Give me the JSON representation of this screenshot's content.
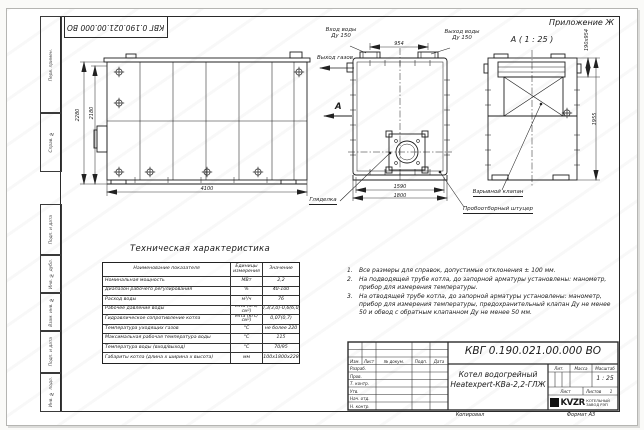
{
  "sheet": {
    "appendix_label": "Приложение Ж",
    "doc_number_flipped": "КВГ 0.190.021.00.000 ВО",
    "margin_stamps": [
      "Перв. примен.",
      "Справ. №",
      "Подп. и дата",
      "Инв. № дубл.",
      "Взам. инв. №",
      "Подп. и дата",
      "Инв. № подл."
    ],
    "copied_label": "Копировал",
    "format_label": "Формат А3"
  },
  "views": {
    "side": {
      "dim_height_total": "2280",
      "dim_height_body": "2180",
      "dim_length": "4100",
      "sight_glass_label": "Гляделка"
    },
    "plan": {
      "dim_flange_span": "954",
      "dim_inner_width": "1590",
      "dim_width": "1800",
      "inlet_line1": "Вход воды",
      "inlet_line2": "Ду 150",
      "outlet_line1": "Выход воды",
      "outlet_line2": "Ду 150",
      "gas_outlet_label": "Выход газов",
      "section_arrow_letter": "А"
    },
    "section": {
      "view_title": "А ( 1 : 25 )",
      "dim_valve": "190х954",
      "dim_height": "1955",
      "explosion_valve_label": "Взрывной клапан",
      "sampling_fitting_label": "Пробоотборный штуцер"
    }
  },
  "spec_table": {
    "title": "Техническая характеристика",
    "headers": [
      "Наименование показателя",
      "Единицы измерения",
      "Значение"
    ],
    "rows": [
      [
        "Номинальная мощность",
        "МВт",
        "2,2"
      ],
      [
        "Диапазон рабочего регулирования",
        "%",
        "40-100"
      ],
      [
        "Расход воды",
        "м³/ч",
        "76"
      ],
      [
        "Рабочее давление воды",
        "МПа (кгс/см²)",
        "0,3(3,0)-0,6(6,0)"
      ],
      [
        "Гидравлическое сопротивление котла",
        "МПа (кгс/см²)",
        "0,07(0,7)"
      ],
      [
        "Температура уходящих газов",
        "°С",
        "не более 220"
      ],
      [
        "Максимальная рабочая температура воды",
        "°С",
        "115"
      ],
      [
        "Температура воды (вход/выход)",
        "°С",
        "70/95"
      ],
      [
        "Габариты котла (длина х ширина х высота)",
        "мм",
        "4100х1800х2280"
      ]
    ]
  },
  "notes": [
    "Все размеры для справок, допустимые отклонения ± 100 мм.",
    "На подводящей трубе котла, до запорной арматуры установлены: манометр, прибор для измерения температуры.",
    "На отводящей трубе котла, до запорной арматуры установлены: манометр, прибор для измерения температуры, предохранительный клапан Ду не менее 50 и обвод с обратным клапанном Ду не менее 50 мм."
  ],
  "title_block": {
    "doc_number": "КВГ 0.190.021.00.000 ВО",
    "product_line1": "Котел водогрейный",
    "product_line2": "Heatexpert-КВа-2,2-ГЛЖ",
    "header_cols": [
      "Изм.",
      "Лист",
      "№ докум.",
      "Подп.",
      "Дата"
    ],
    "signature_rows": [
      "Разраб.",
      "Пров.",
      "Т. контр.",
      "Нач. отд.",
      "Н. контр.",
      "Утв."
    ],
    "lit_label": "Лит.",
    "mass_label": "Масса",
    "scale_label": "Масштаб",
    "scale_value": "1 : 25",
    "sheet_label": "Лист",
    "sheets_label": "Листов",
    "sheets_value": "1",
    "logo_text": "KVZR",
    "logo_line1": "КОТЕЛЬНЫЙ",
    "logo_line2": "ЗАВОД РЭП"
  }
}
